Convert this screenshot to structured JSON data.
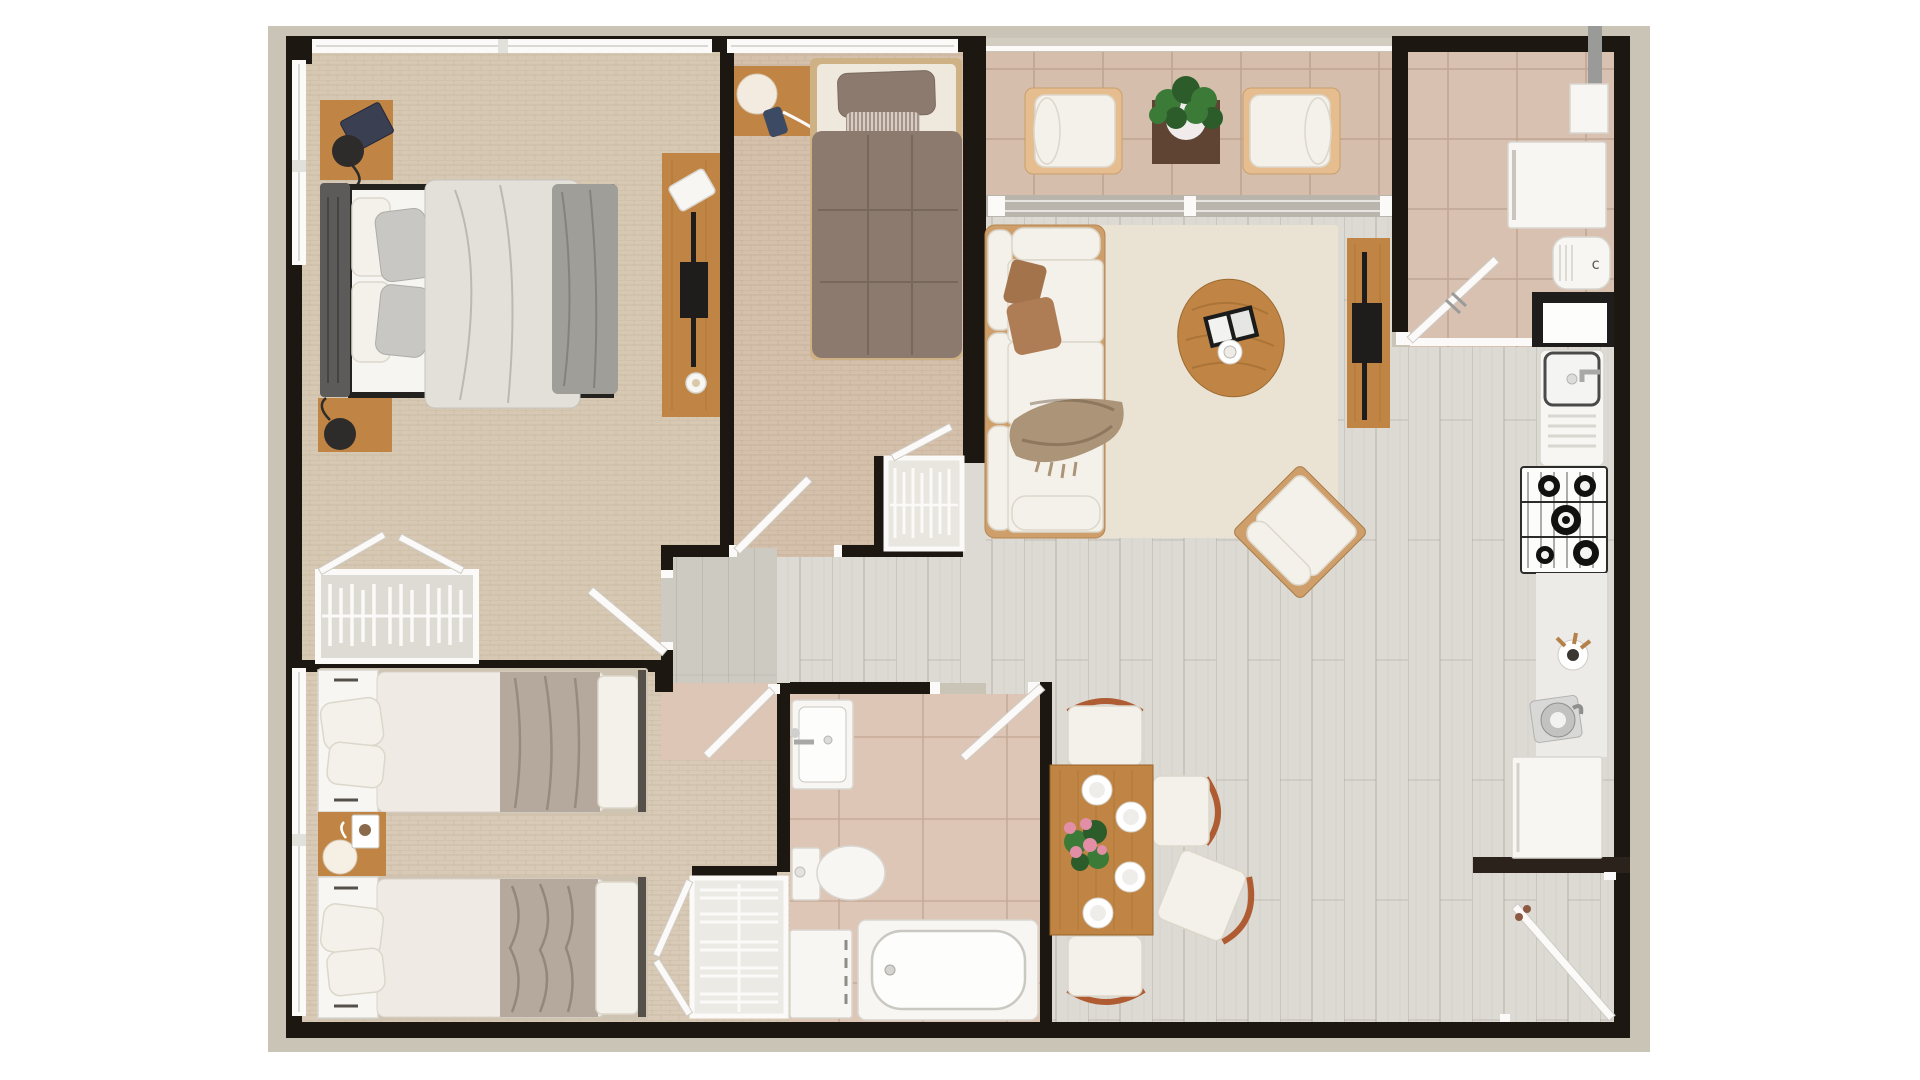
{
  "meta": {
    "view": "apartment-floor-plan-top-view",
    "style": "3d-rendered-plan",
    "rooms": [
      {
        "id": "master-bedroom",
        "position": "top-left",
        "floor": "beige-carpet"
      },
      {
        "id": "second-bedroom",
        "position": "top-middle",
        "floor": "beige-carpet"
      },
      {
        "id": "balcony",
        "position": "top-right",
        "floor": "terracotta-tile"
      },
      {
        "id": "living-room",
        "position": "center-right",
        "floor": "light-wood-plank"
      },
      {
        "id": "kitchen",
        "position": "right",
        "floor": "terracotta-tile"
      },
      {
        "id": "dining-area",
        "position": "bottom-center-right",
        "floor": "light-wood-plank"
      },
      {
        "id": "bathroom",
        "position": "bottom-center",
        "floor": "beige-tile"
      },
      {
        "id": "kids-bedroom",
        "position": "bottom-left",
        "floor": "beige-carpet"
      },
      {
        "id": "entry",
        "position": "bottom-right",
        "floor": "light-wood-plank"
      }
    ],
    "furniture": [
      "double-bed",
      "single-bed",
      "twin-bed",
      "twin-bed",
      "wardrobe-open",
      "wardrobe-hangers",
      "closet-shelves",
      "sofa",
      "accent-chair",
      "coffee-table",
      "tv-console",
      "dresser-with-tv",
      "armchair",
      "armchair",
      "plant-table",
      "dining-table",
      "dining-chair",
      "dining-chair",
      "dining-chair",
      "dining-chair",
      "fridge",
      "small-appliance",
      "kitchen-sink",
      "gas-stove",
      "counter",
      "kettle",
      "base-cabinet",
      "washbasin",
      "toilet",
      "washing-machine",
      "bathtub",
      "nightstand",
      "table-lamp",
      "smartphone",
      "magazine"
    ]
  },
  "labels": {
    "appliance_mark": "c"
  },
  "palette": {
    "page": "#ffffff",
    "ground": "#cac4b6",
    "wall": "#1d1712",
    "wall_soft": "#2b221b",
    "window": "#fbfaf8",
    "window_line": "#cfccc6",
    "carpet_master": "#d7c8b3",
    "carpet_bed2": "#d4c0ab",
    "carpet_bed3": "#d8cab6",
    "tile_balcony": "#d5beac",
    "tile_kitchen": "#d8c1b0",
    "tile_bath": "#ddc6b5",
    "corridor_tile": "#cdcac2",
    "plank": "#dcdad3",
    "rug": "#eae2d3",
    "track": "#b9b5ad",
    "railing": "#d2cdc0",
    "wood": "#c08544",
    "wood_dark": "#9a6527",
    "walnut": "#5f4434",
    "sofa_frame": "#cf9f6b",
    "armchair_frame": "#e5bd8e",
    "cushion": "#f4f1ea",
    "cushion_shadow": "#dcd7cb",
    "pillow_brown": "#a3744c",
    "pillow_brown2": "#af7d55",
    "throw": "#ab9478",
    "duvet_taupe": "#8d7a6e",
    "duvet_light": "#e3e0da",
    "blanket_gray": "#a09e99",
    "blanket_taupe": "#b4a99c",
    "headboard_gray": "#5c5b59",
    "mattress": "#f6f5f2",
    "pillow_silver": "#c9c7c3",
    "fixture_white": "#f7f6f3",
    "steel": "#c6c6c4",
    "black_item": "#1f1d1b",
    "chair_accent_wood": "#b05c32",
    "plant": "#3c7a38",
    "plant_dark": "#2c5c2a",
    "flower": "#e18ea6",
    "counter": "#edebe7"
  }
}
